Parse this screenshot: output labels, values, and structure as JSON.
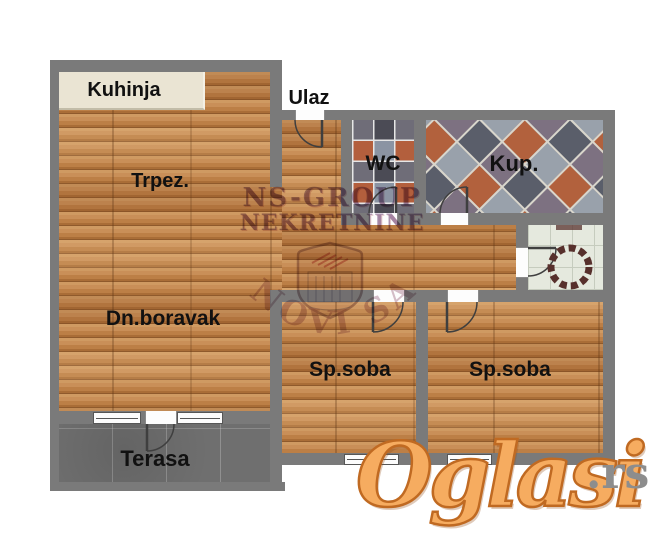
{
  "plan": {
    "rooms": {
      "kitchen": "Kuhinja",
      "entrance": "Ulaz",
      "dining": "Trpez.",
      "wc": "WC",
      "bathroom": "Kup.",
      "living": "Dn.boravak",
      "bedroom1": "Sp.soba",
      "bedroom2": "Sp.soba",
      "terrace": "Terasa"
    }
  },
  "watermarks": {
    "agency": {
      "line1": "NS-GROUP",
      "line2": "NEKRETNINE",
      "city": "NOVI SAD"
    },
    "site": {
      "name": "Oglasi",
      "tld": ".rs"
    }
  },
  "colors": {
    "wall": "#7a7a7a",
    "wood": "#c2854f",
    "terrace_floor": "#6f6f6f",
    "kitchen_counter": "#eae4d3",
    "wc_tile_dark": "#4b4b55",
    "wc_tile_blue": "#8b94a3",
    "wc_tile_orange": "#b35f3d",
    "loggia_tile": "#e5e9de",
    "site_logo_orange": "#f6ac60",
    "site_logo_gray": "#8d8d8d",
    "agency_purple": "rgba(100,60,115,0.5)"
  }
}
